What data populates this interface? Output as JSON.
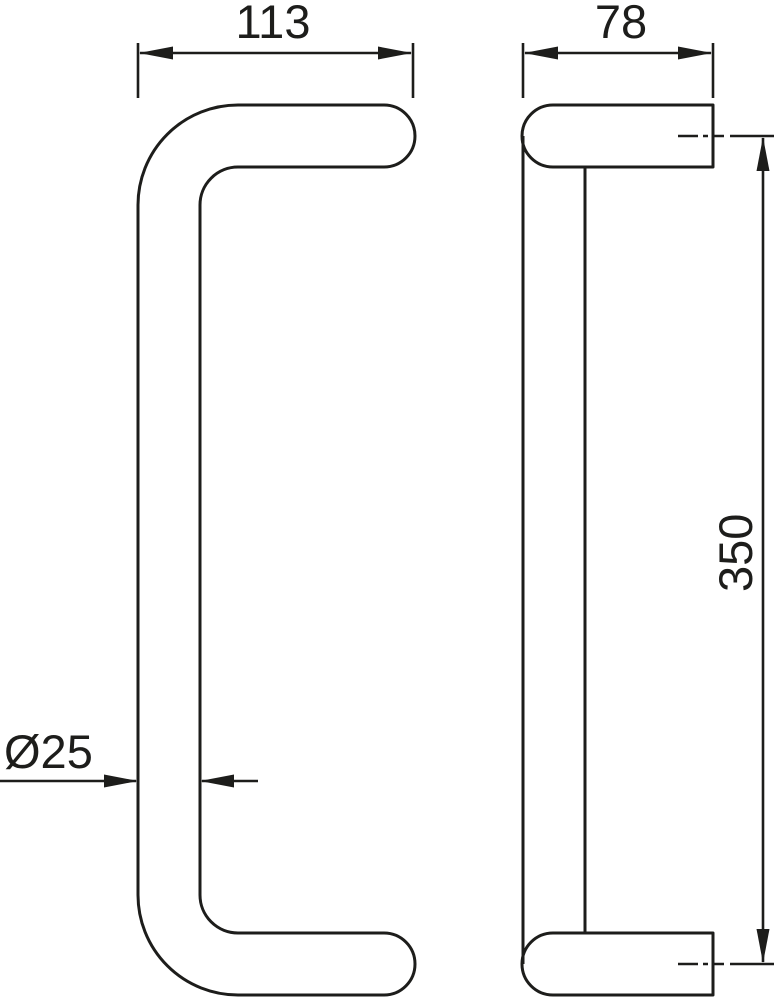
{
  "drawing": {
    "background": "#ffffff",
    "line_color": "#1d1d1b",
    "dimensions": {
      "grip_width": "113",
      "depth": "78",
      "length": "350",
      "tube_diameter": "Ø25"
    }
  }
}
